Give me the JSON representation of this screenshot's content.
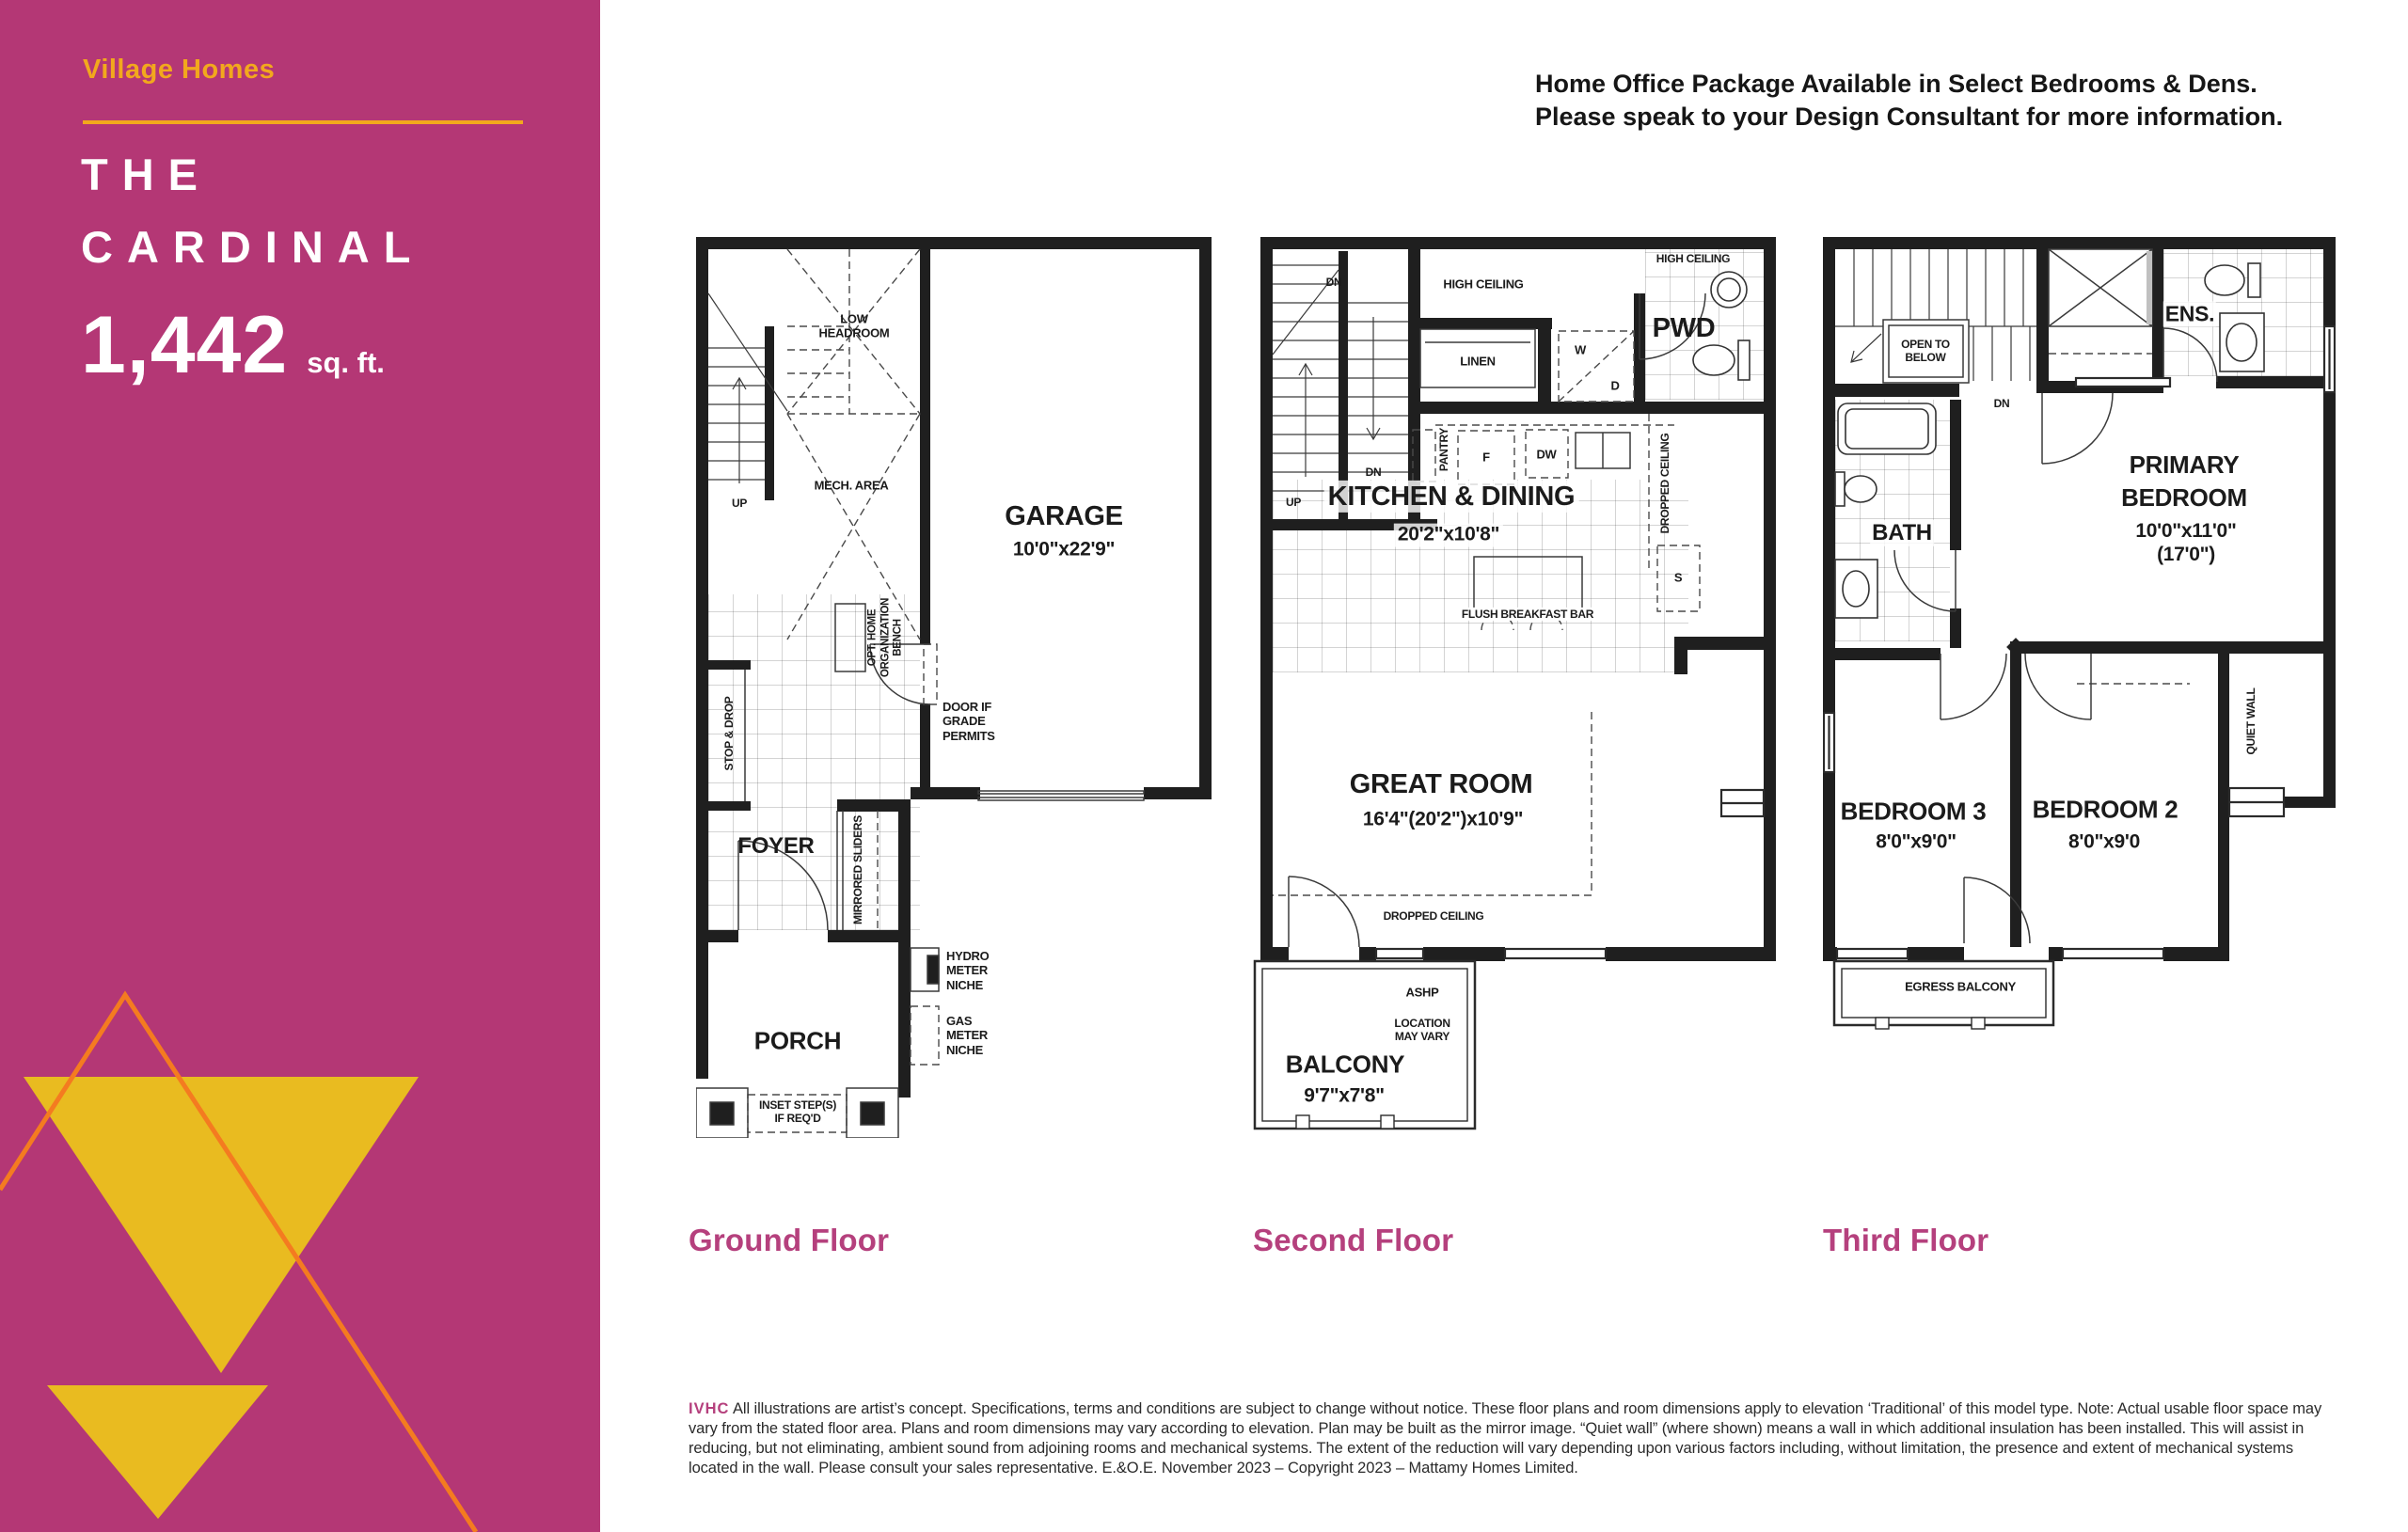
{
  "colors": {
    "sidebar_magenta": "#b43775",
    "brand_gold": "#f2a81d",
    "triangle_yellow": "#e9bb20",
    "triangle_orange": "#f47b20",
    "caption_magenta": "#b5407d",
    "plan_ink": "#1f1f1f"
  },
  "sidebar": {
    "brand": "Village Homes",
    "title_line1": "THE",
    "title_line2": "CARDINAL",
    "sqft": "1,442",
    "sqft_unit": "sq. ft."
  },
  "header": {
    "line1": "Home Office Package Available in Select Bedrooms & Dens.",
    "line2": "Please speak to your Design Consultant for more information."
  },
  "floors": {
    "ground": {
      "caption": "Ground Floor",
      "labels": {
        "low_headroom": "LOW\nHEADROOM",
        "mech_area": "MECH. AREA",
        "up": "UP",
        "garage": "GARAGE",
        "garage_dim": "10'0\"x22'9\"",
        "stop_drop": "STOP & DROP",
        "opt_home": "OPT. HOME\nORGANIZATION\nBENCH",
        "door_if": "DOOR IF\nGRADE\nPERMITS",
        "foyer": "FOYER",
        "mirrored_sliders": "MIRRORED SLIDERS",
        "hydro": "HYDRO\nMETER\nNICHE",
        "gas": "GAS\nMETER\nNICHE",
        "porch": "PORCH",
        "inset_steps": "INSET STEP(S)\nIF REQ'D"
      }
    },
    "second": {
      "caption": "Second Floor",
      "labels": {
        "dn_a": "DN",
        "dn_b": "DN",
        "up": "UP",
        "high_ceiling_main": "HIGH CEILING",
        "high_ceiling_pwd": "HIGH CEILING",
        "linen": "LINEN",
        "w": "W",
        "d": "D",
        "pwd": "PWD",
        "pantry": "PANTRY",
        "f": "F",
        "dw": "DW",
        "s": "S",
        "dropped_ceiling_right": "DROPPED CEILING",
        "kitchen": "KITCHEN & DINING",
        "kitchen_dim": "20'2\"x10'8\"",
        "flush_bar": "FLUSH BREAKFAST BAR",
        "great_room": "GREAT ROOM",
        "great_room_dim": "16'4\"(20'2\")x10'9\"",
        "dropped_ceiling_bottom": "DROPPED CEILING",
        "ashp": "ASHP",
        "ashp_note": "LOCATION\nMAY VARY",
        "balcony": "BALCONY",
        "balcony_dim": "9'7\"x7'8\""
      }
    },
    "third": {
      "caption": "Third Floor",
      "labels": {
        "open_below": "OPEN TO\nBELOW",
        "dn": "DN",
        "ens": "ENS.",
        "bath": "BATH",
        "primary": "PRIMARY\nBEDROOM",
        "primary_dim": "10'0\"x11'0\"(17'0\")",
        "bed3": "BEDROOM 3",
        "bed3_dim": "8'0\"x9'0\"",
        "bed2": "BEDROOM 2",
        "bed2_dim": "8'0\"x9'0",
        "quiet_wall": "QUIET WALL",
        "egress": "EGRESS BALCONY"
      }
    }
  },
  "disclaimer": {
    "code": "IVHC",
    "body": " All illustrations are artist’s concept. Specifications, terms and conditions are subject to change without notice. These floor plans and room dimensions apply to elevation ‘Traditional’ of this model type. Note: Actual usable floor space may vary from the stated floor area. Plans and room dimensions may vary according to elevation. Plan may be built as the mirror image. “Quiet wall” (where shown) means a wall in which additional insulation has been installed. This will assist in reducing, but not eliminating, ambient sound from adjoining rooms and mechanical systems. The extent of the reduction will vary depending upon various factors including, without limitation, the presence and extent of mechanical systems located in the wall. Please consult your sales representative. E.&O.E. November 2023 – Copyright 2023 – Mattamy Homes Limited."
  }
}
